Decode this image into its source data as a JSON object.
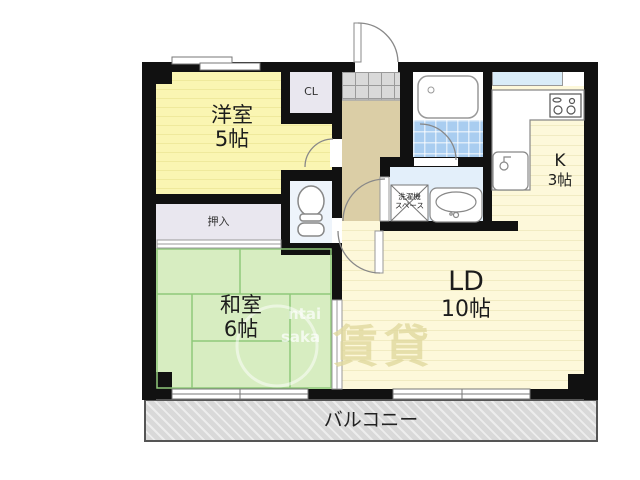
{
  "rooms": {
    "western": {
      "name": "洋室",
      "size": "5帖"
    },
    "japanese": {
      "name": "和室",
      "size": "6帖"
    },
    "living_dining": {
      "name": "LD",
      "size": "10帖"
    },
    "kitchen": {
      "name": "K",
      "size": "3帖"
    },
    "closet": {
      "label": "CL"
    },
    "oshiire": {
      "label": "押入"
    },
    "laundry_space": {
      "line1": "洗濯機",
      "line2": "スペース"
    },
    "balcony": {
      "label": "バルコニー"
    }
  },
  "watermark": {
    "latin_line1": "ntai",
    "latin_line2": "saka",
    "kanji": "賃貸"
  },
  "icons": {
    "entrance_door": "entrance-door-icon",
    "toilet": "toilet-icon",
    "bathtub": "bathtub-icon",
    "stove": "stove-icon",
    "kitchen_sink": "kitchen-sink-icon",
    "washbasin": "washbasin-icon",
    "laundry_box": "laundry-crossbox-icon",
    "window": "sliding-window-icon",
    "sliding_door": "sliding-door-icon"
  },
  "colors": {
    "wall": "#111111",
    "western_room": "#faf5b2",
    "western_stripe": "#efe99c",
    "japanese_room": "#d7edc1",
    "tatami_line": "#8fc97a",
    "ld_floor": "#fdf8da",
    "floor_stripe": "#f1ebc2",
    "hallway": "#dbcea6",
    "genkan_tile": "#d9d9d9",
    "bath_tile": "#a9cdf0",
    "wet_floor": "#e3effa",
    "toilet_floor": "#eef4fb",
    "closet": "#e9e7ef",
    "kitchen_window": "#d9ecf8",
    "balcony": "#d9d9d9"
  }
}
